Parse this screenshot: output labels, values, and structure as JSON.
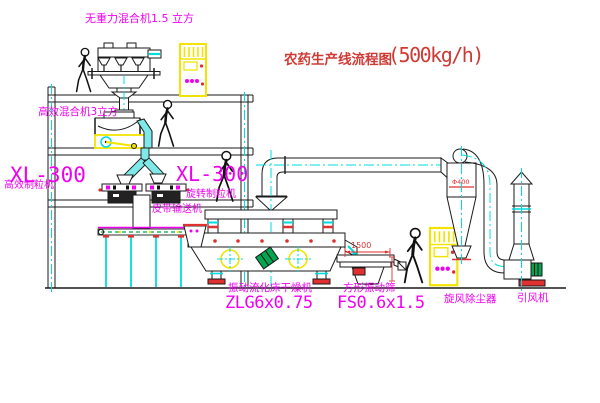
{
  "title": {
    "name": "农药生产线流程图",
    "capacity": "(500kg/h)"
  },
  "labels": {
    "top_mixer": "无重力混合机1.5 立方",
    "mixer2": "高效混合机3立方",
    "xl300_left": "XL-300",
    "granulator_left": "高效制粒机",
    "xl300_mid": "XL-300",
    "granulator_mid": "旋转制粒机",
    "conveyor": "皮带输送机",
    "dryer_name": "振动流化床干燥机",
    "dryer_model": "ZLG6x0.75",
    "sieve_name": "方形振动筛",
    "sieve_model": "FS0.6x1.5",
    "cyclone": "旋风除尘器",
    "fan": "引风机"
  },
  "dimensions": {
    "sieve_length": "1500",
    "cyclone_diameter": "Φ400"
  },
  "colors": {
    "label_magenta": "#f000f0",
    "title_red": "#cf3a35",
    "dimension_red": "#e03030",
    "equipment_yellow": "#f2e400",
    "centerline_cyan": "#00dcdc",
    "motor_green": "#00a651"
  }
}
